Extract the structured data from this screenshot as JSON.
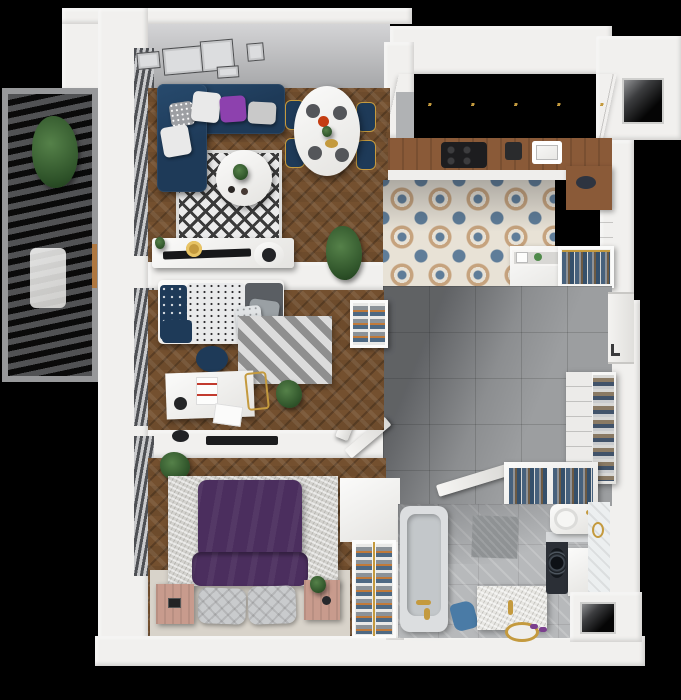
{
  "scene": {
    "kind": "isometric-apartment-floorplan-3d-render",
    "background": "#000000",
    "width_px": 681,
    "height_px": 700
  },
  "palette": {
    "wall": "#f1f0ee",
    "wall-shade": "#d9d7d3",
    "wood": "#74502f",
    "navy": "#1e3a58",
    "rug-base": "#ebebeb",
    "rug-diamond": "#3b3b3b",
    "chevron-a": "#dcdcdc",
    "chevron-b": "#8f8f8f",
    "tile-hall": "#9c9ea0",
    "tile-bath": "#b7b9bb",
    "kt-base": "#e8e2d6",
    "kt-blue": "#5f7d99",
    "kt-tan": "#c6a37e",
    "counter-wood": "#8a5a38",
    "gold": "#c49a3e",
    "pink-wood": "#c89b8d",
    "bed-purple": "#4b2e5e",
    "pillow-purple": "#8d41ae",
    "marble": "#d3d2ce",
    "plant-green": "#3f6b3c",
    "denim": "#4f6b85",
    "clothes-orange": "#c07a3a",
    "clothes-gray": "#8b9298",
    "cooktop-black": "#1d1d1f",
    "shadow": "#16181c"
  },
  "rooms": [
    {
      "name": "balcony",
      "items": [
        "louvered-slat-roof",
        "potted-plant",
        "lounge-seat",
        "ladder"
      ]
    },
    {
      "name": "living-room",
      "floor": "herringbone-wood",
      "items": [
        "gallery-wall-frames",
        "corner-sofa-navy",
        "throw-pillows",
        "diamond-pattern-rug",
        "round-coffee-table",
        "tv-console",
        "flatscreen-tv",
        "wall-clock-gold",
        "record-player",
        "potted-plant",
        "window-blinds"
      ]
    },
    {
      "name": "dining-area",
      "items": [
        "oval-dining-table",
        "navy-dining-chairs",
        "table-settings",
        "flower-vase"
      ]
    },
    {
      "name": "kitchen",
      "floor": "patterned-cement-tile",
      "items": [
        "upper-cabinets",
        "wood-countertop",
        "induction-cooktop",
        "sink",
        "coffee-machine",
        "wood-desk",
        "base-cabinet",
        "dresser-open-drawer",
        "wardrobe-hanging-clothes",
        "ventilation-shaft"
      ]
    },
    {
      "name": "bedroom-1",
      "floor": "herringbone-wood",
      "items": [
        "single-bed",
        "navy-patterned-pillows",
        "speckled-duvet",
        "navy-pouf",
        "chevron-rug",
        "white-desk",
        "desk-chair",
        "gold-frame-chair",
        "potted-plant",
        "wall-niche-shelves",
        "open-door",
        "window-blinds"
      ]
    },
    {
      "name": "bedroom-2",
      "floor": "herringbone-wood",
      "items": [
        "double-bed-purple-duvet",
        "quilted-gray-pillows",
        "marble-area-rug",
        "nightstand-left",
        "nightstand-right",
        "wardrobe-folded-clothes",
        "potted-plant",
        "wall-mounted-tv",
        "open-door",
        "window-blinds"
      ]
    },
    {
      "name": "hallway",
      "floor": "gray-tile",
      "items": [
        "shoe-cabinet",
        "entry-door",
        "wardrobe-hanging-clothes",
        "dresser",
        "open-doors",
        "cast-shadow"
      ]
    },
    {
      "name": "bathroom",
      "floor": "gray-tile",
      "items": [
        "bathtub",
        "gold-faucet",
        "floor-mat",
        "blue-towel",
        "marble-vanity-sink",
        "washing-machine",
        "washer-cabinet",
        "toilet",
        "white-tiled-wall",
        "ventilation-shaft",
        "open-door"
      ]
    }
  ]
}
